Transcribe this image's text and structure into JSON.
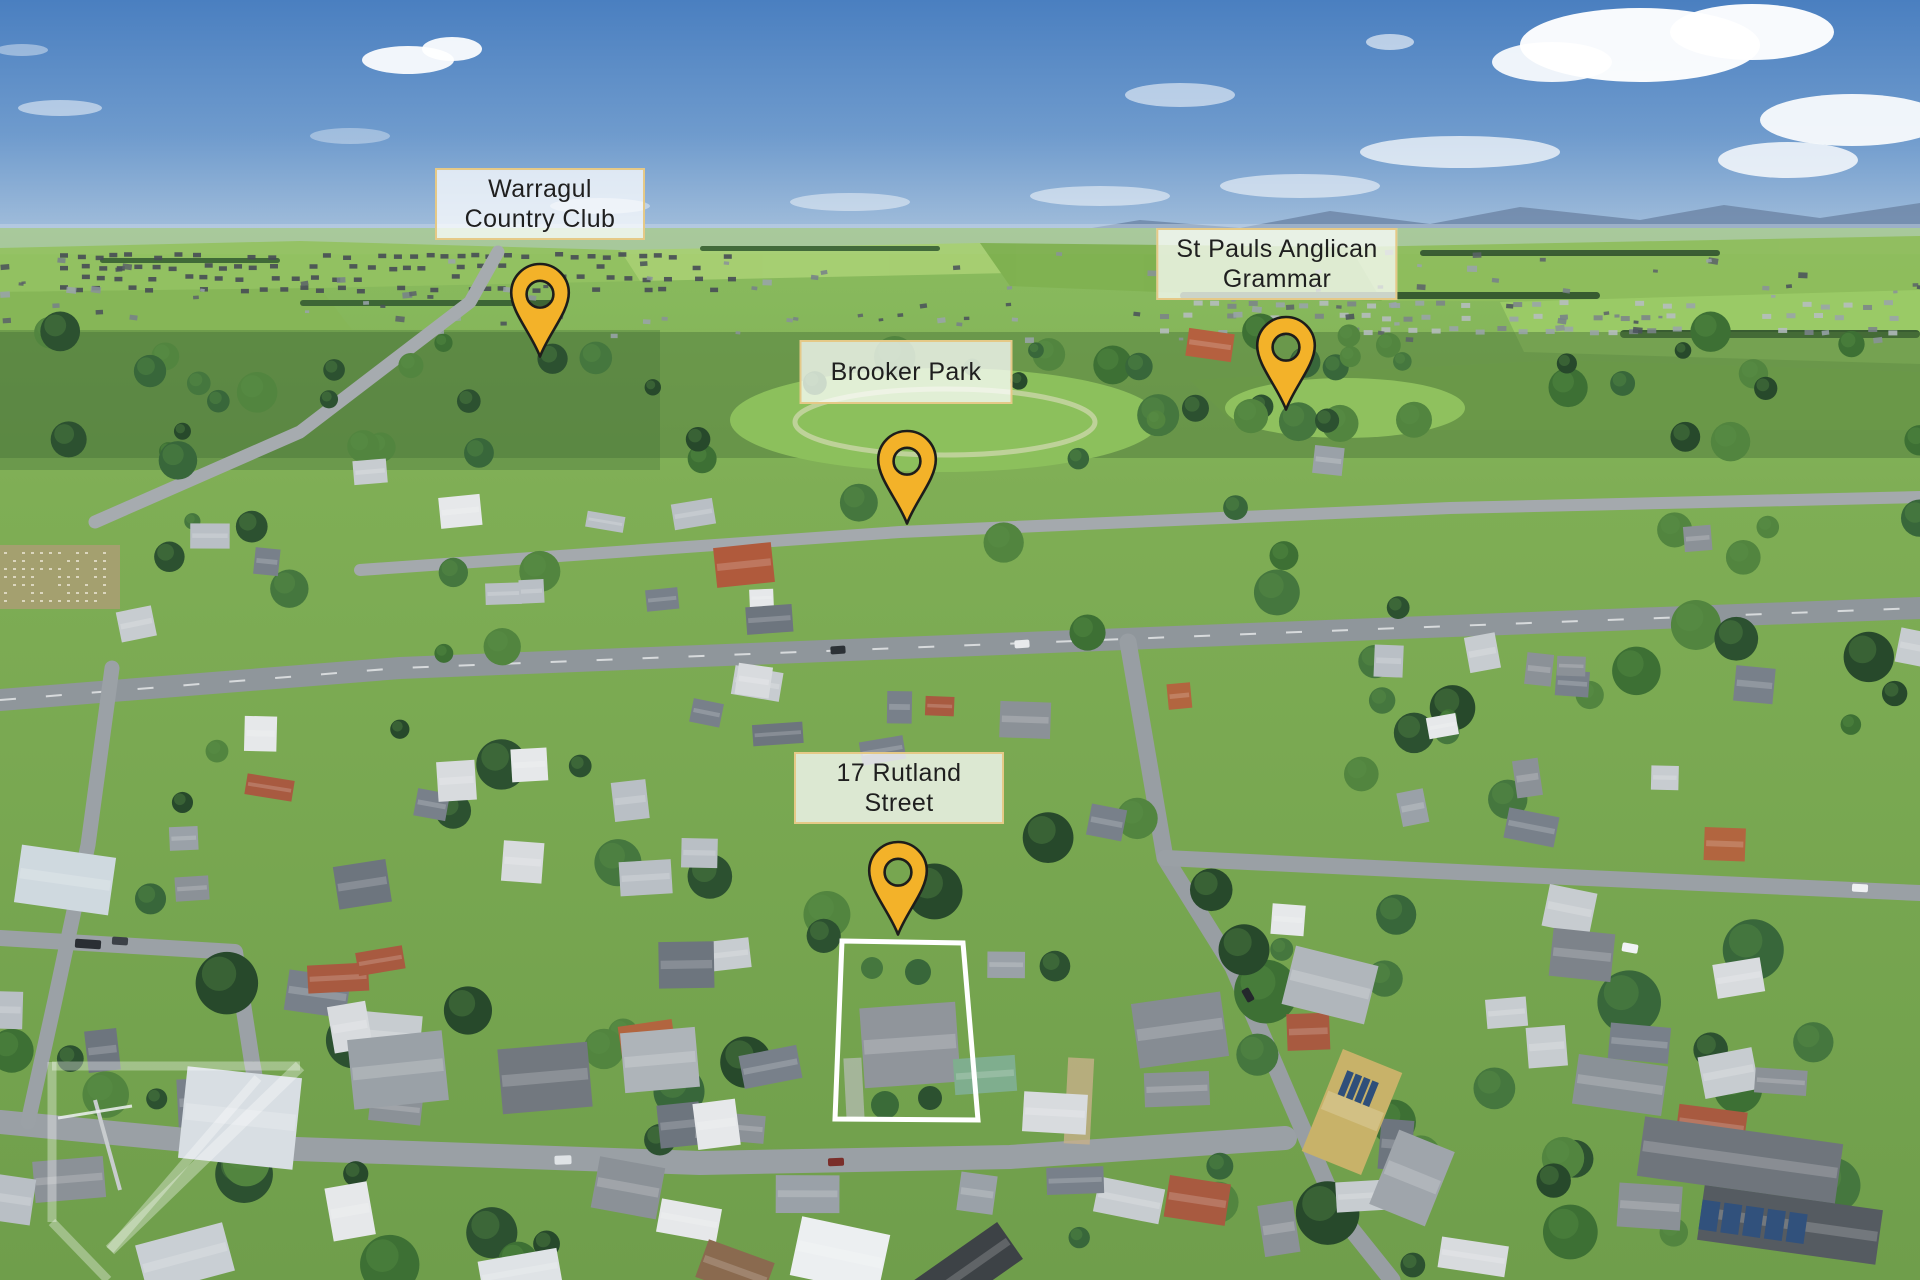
{
  "markers": {
    "warragul_country_club": {
      "line1": "Warragul",
      "line2": "Country Club"
    },
    "brooker_park": {
      "line1": "Brooker Park",
      "line2": ""
    },
    "st_pauls_anglican_grammar": {
      "line1": "St Pauls Anglican",
      "line2": "Grammar"
    },
    "rutland_street": {
      "line1": "17 Rutland",
      "line2": "Street"
    }
  },
  "colors": {
    "pin_fill": "#F3B229",
    "pin_stroke": "#1D1D1B",
    "label_border": "#E5C987",
    "label_background": "rgba(255,255,255,0.74)",
    "boundary_outline": "#FFFFFF"
  }
}
